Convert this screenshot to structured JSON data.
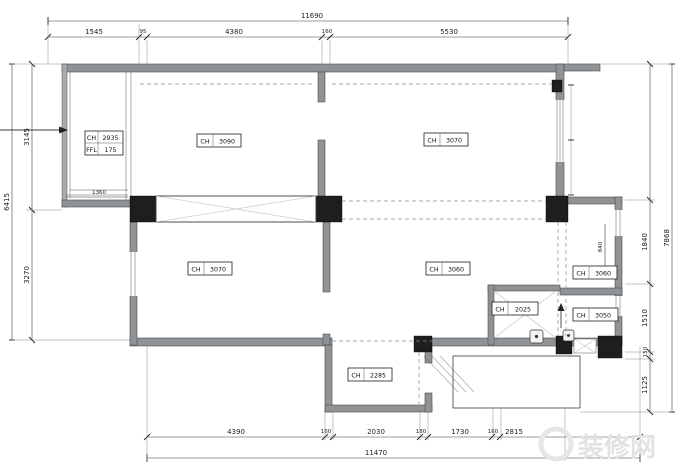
{
  "dimensions": {
    "top": {
      "overall": "11690",
      "segments": [
        "1545",
        "95",
        "4380",
        "160",
        "5530"
      ]
    },
    "bottom": {
      "overall": "11470",
      "segments": [
        "4390",
        "160",
        "2030",
        "180",
        "1730",
        "160",
        "2815"
      ]
    },
    "left": {
      "overall": "6415",
      "segments": [
        "3145",
        "3270"
      ]
    },
    "right": {
      "overall": "7868",
      "segments": [
        "1840",
        "1510",
        "150",
        "1125"
      ]
    },
    "interior": {
      "balcony_width": "1360",
      "right_room_width": "840"
    }
  },
  "room_labels": {
    "balcony": {
      "rows": [
        {
          "key": "CH",
          "val": "2935"
        },
        {
          "key": "FFL",
          "val": "175"
        }
      ]
    },
    "bedroom_top_left": {
      "key": "CH",
      "val": "3090"
    },
    "room_top_right": {
      "key": "CH",
      "val": "3070"
    },
    "bedroom_mid_left": {
      "key": "CH",
      "val": "3070"
    },
    "living": {
      "key": "CH",
      "val": "3060"
    },
    "right_room_upper": {
      "key": "CH",
      "val": "3060"
    },
    "right_room_lower": {
      "key": "CH",
      "val": "3050"
    },
    "bathroom": {
      "key": "CH",
      "val": "2025"
    },
    "entry": {
      "key": "CH",
      "val": "2285"
    }
  },
  "watermark": "装修网"
}
